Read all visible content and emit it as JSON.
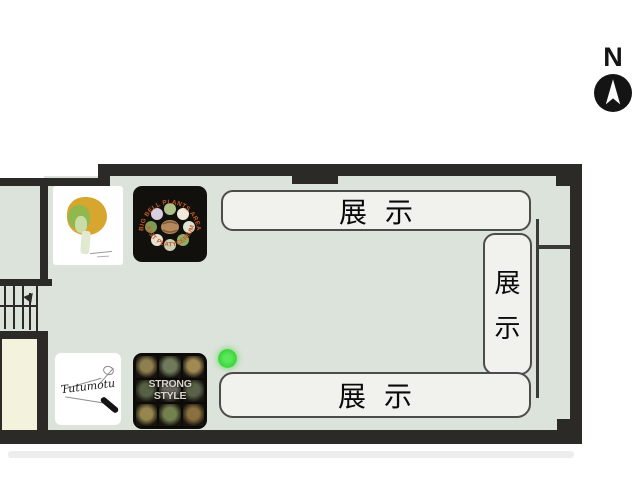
{
  "compass": {
    "label": "N"
  },
  "exhibits": {
    "top": {
      "label": "展示"
    },
    "bottom": {
      "label": "展示"
    },
    "right": {
      "char1": "展",
      "char2": "示"
    }
  },
  "posters": {
    "big_bell": {
      "arc_top": "BIG BELL PLANTS AREA",
      "arc_bottom": "JUST PLATYCERIUM"
    },
    "strong_style": {
      "title": "STRONG STYLE"
    }
  },
  "cards": {
    "tutumotu": {
      "signature": "Tutumotu"
    }
  },
  "colors": {
    "floor": "#dce3da",
    "wall": "#2b2a26",
    "box_fill": "#f1f2ee",
    "box_border": "#4c4c4a",
    "beige_room": "#f2f2dd",
    "green_marker": "#3fd33f",
    "poster_background": "#0d0b08",
    "arc_text": "#c75b2c"
  }
}
